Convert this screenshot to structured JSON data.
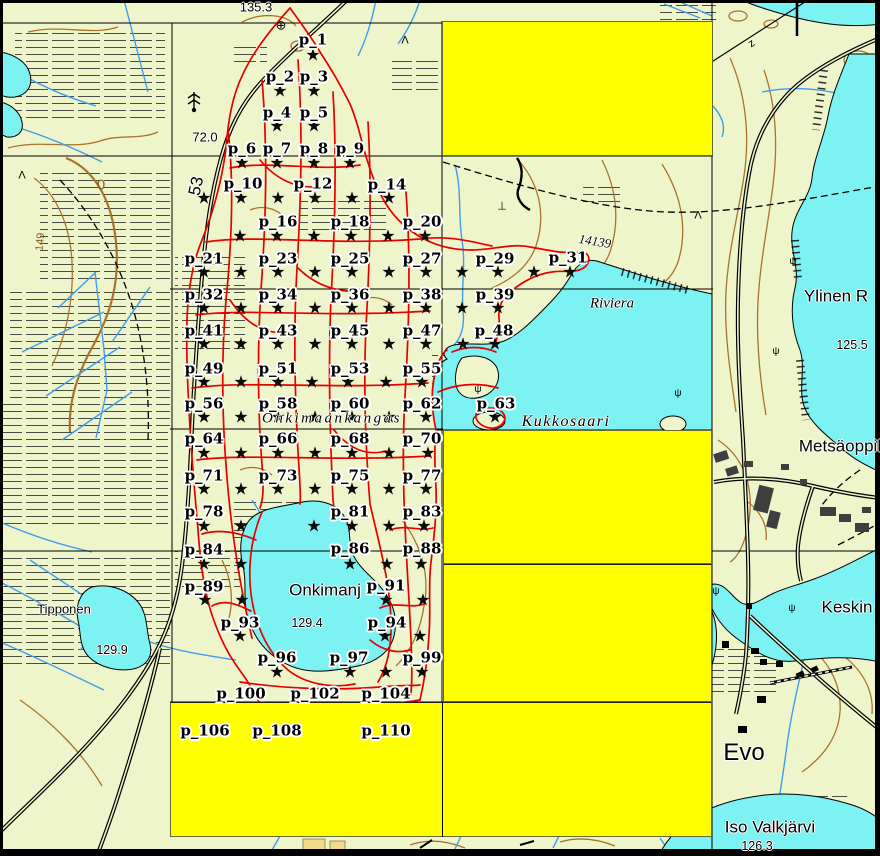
{
  "map_view": {
    "colors": {
      "terrain": "#EFF5CB",
      "water": "#7DF2F2",
      "highlight": "#FFFF00",
      "trail": "#E60000",
      "contour": "#A9732C",
      "stream": "#3E9CEE",
      "road": "#000000",
      "grid": "#000000",
      "building": "#3F3F3F",
      "sand": "#F2D98B",
      "label_halo": "#FFFFFF",
      "label_text": "#000000"
    },
    "sample_points": {
      "marker_glyph": "★",
      "labels": [
        {
          "label": "p_1",
          "x": 313,
          "y": 40
        },
        {
          "label": "p_2",
          "x": 280,
          "y": 77
        },
        {
          "label": "p_3",
          "x": 314,
          "y": 77
        },
        {
          "label": "p_4",
          "x": 277,
          "y": 113
        },
        {
          "label": "p_5",
          "x": 314,
          "y": 113
        },
        {
          "label": "p_6",
          "x": 242,
          "y": 149
        },
        {
          "label": "p_7",
          "x": 277,
          "y": 149
        },
        {
          "label": "p_8",
          "x": 314,
          "y": 149
        },
        {
          "label": "p_9",
          "x": 350,
          "y": 149
        },
        {
          "label": "p_10",
          "x": 243,
          "y": 184
        },
        {
          "label": "p_12",
          "x": 313,
          "y": 184
        },
        {
          "label": "p_14",
          "x": 387,
          "y": 185
        },
        {
          "label": "p_16",
          "x": 278,
          "y": 222
        },
        {
          "label": "p_18",
          "x": 350,
          "y": 222
        },
        {
          "label": "p_20",
          "x": 422,
          "y": 222
        },
        {
          "label": "p_21",
          "x": 204,
          "y": 259
        },
        {
          "label": "p_23",
          "x": 278,
          "y": 259
        },
        {
          "label": "p_25",
          "x": 350,
          "y": 259
        },
        {
          "label": "p_27",
          "x": 422,
          "y": 259
        },
        {
          "label": "p_29",
          "x": 495,
          "y": 259
        },
        {
          "label": "p_31",
          "x": 568,
          "y": 258
        },
        {
          "label": "p_32",
          "x": 204,
          "y": 295
        },
        {
          "label": "p_34",
          "x": 278,
          "y": 295
        },
        {
          "label": "p_36",
          "x": 350,
          "y": 295
        },
        {
          "label": "p_38",
          "x": 422,
          "y": 295
        },
        {
          "label": "p_39",
          "x": 495,
          "y": 295
        },
        {
          "label": "p_41",
          "x": 204,
          "y": 331
        },
        {
          "label": "p_43",
          "x": 278,
          "y": 331
        },
        {
          "label": "p_45",
          "x": 350,
          "y": 331
        },
        {
          "label": "p_47",
          "x": 422,
          "y": 331
        },
        {
          "label": "p_48",
          "x": 494,
          "y": 331
        },
        {
          "label": "p_49",
          "x": 204,
          "y": 369
        },
        {
          "label": "p_51",
          "x": 278,
          "y": 369
        },
        {
          "label": "p_53",
          "x": 350,
          "y": 369
        },
        {
          "label": "p_55",
          "x": 422,
          "y": 369
        },
        {
          "label": "p_56",
          "x": 204,
          "y": 404
        },
        {
          "label": "p_58",
          "x": 278,
          "y": 404
        },
        {
          "label": "p_60",
          "x": 350,
          "y": 404
        },
        {
          "label": "p_62",
          "x": 422,
          "y": 404
        },
        {
          "label": "p_63",
          "x": 496,
          "y": 404
        },
        {
          "label": "p_64",
          "x": 204,
          "y": 439
        },
        {
          "label": "p_66",
          "x": 278,
          "y": 439
        },
        {
          "label": "p_68",
          "x": 350,
          "y": 439
        },
        {
          "label": "p_70",
          "x": 422,
          "y": 439
        },
        {
          "label": "p_71",
          "x": 204,
          "y": 476
        },
        {
          "label": "p_73",
          "x": 278,
          "y": 476
        },
        {
          "label": "p_75",
          "x": 350,
          "y": 476
        },
        {
          "label": "p_77",
          "x": 422,
          "y": 476
        },
        {
          "label": "p_78",
          "x": 204,
          "y": 512
        },
        {
          "label": "p_81",
          "x": 350,
          "y": 512
        },
        {
          "label": "p_83",
          "x": 422,
          "y": 512
        },
        {
          "label": "p_84",
          "x": 204,
          "y": 550
        },
        {
          "label": "p_86",
          "x": 350,
          "y": 549
        },
        {
          "label": "p_88",
          "x": 422,
          "y": 549
        },
        {
          "label": "p_89",
          "x": 204,
          "y": 587
        },
        {
          "label": "p_91",
          "x": 386,
          "y": 586
        },
        {
          "label": "p_93",
          "x": 240,
          "y": 623
        },
        {
          "label": "p_94",
          "x": 387,
          "y": 623
        },
        {
          "label": "p_96",
          "x": 277,
          "y": 658
        },
        {
          "label": "p_97",
          "x": 349,
          "y": 658
        },
        {
          "label": "p_99",
          "x": 422,
          "y": 658
        },
        {
          "label": "p_100",
          "x": 241,
          "y": 694
        },
        {
          "label": "p_102",
          "x": 315,
          "y": 694
        },
        {
          "label": "p_104",
          "x": 386,
          "y": 694
        },
        {
          "label": "p_106",
          "x": 205,
          "y": 731
        },
        {
          "label": "p_108",
          "x": 277,
          "y": 731
        },
        {
          "label": "p_110",
          "x": 386,
          "y": 731
        }
      ]
    },
    "star_rows": [
      {
        "y": 57,
        "xs": [
          313
        ]
      },
      {
        "y": 93,
        "xs": [
          280,
          314
        ]
      },
      {
        "y": 128,
        "xs": [
          277,
          314
        ]
      },
      {
        "y": 165,
        "xs": [
          242,
          277,
          314,
          350
        ]
      },
      {
        "y": 200,
        "xs": [
          204,
          241,
          278,
          315,
          352,
          389
        ]
      },
      {
        "y": 238,
        "xs": [
          240,
          277,
          314,
          351,
          388,
          425
        ]
      },
      {
        "y": 274,
        "xs": [
          204,
          241,
          278,
          315,
          352,
          389,
          426,
          462,
          498,
          534,
          570
        ]
      },
      {
        "y": 310,
        "xs": [
          204,
          241,
          278,
          315,
          352,
          389,
          426,
          462,
          498
        ]
      },
      {
        "y": 346,
        "xs": [
          204,
          241,
          278,
          315,
          352,
          389,
          426,
          463,
          495
        ]
      },
      {
        "y": 384,
        "xs": [
          204,
          241,
          278,
          312,
          348,
          386,
          422
        ]
      },
      {
        "y": 419,
        "xs": [
          204,
          241,
          278,
          315,
          352,
          389,
          426,
          495
        ]
      },
      {
        "y": 455,
        "xs": [
          204,
          241,
          278,
          315,
          352,
          389,
          428
        ]
      },
      {
        "y": 491,
        "xs": [
          204,
          241,
          278,
          315,
          352,
          389,
          426
        ]
      },
      {
        "y": 528,
        "xs": [
          204,
          241,
          314,
          352,
          389,
          424
        ]
      },
      {
        "y": 566,
        "xs": [
          204,
          241,
          350,
          387,
          421
        ]
      },
      {
        "y": 602,
        "xs": [
          205,
          242,
          386,
          423
        ]
      },
      {
        "y": 638,
        "xs": [
          240,
          385,
          420
        ]
      },
      {
        "y": 674,
        "xs": [
          277,
          350,
          386,
          422
        ]
      }
    ],
    "place_labels": [
      {
        "text": "135.3",
        "x": 256,
        "y": 7,
        "cls": "num-lg"
      },
      {
        "text": "⊕",
        "x": 281,
        "y": 25,
        "cls": "sym"
      },
      {
        "text": "72.0",
        "x": 205,
        "y": 137,
        "cls": "num-lg"
      },
      {
        "text": "53",
        "x": 196,
        "y": 186,
        "cls": "road-num",
        "rot": -78
      },
      {
        "text": "149",
        "x": 41,
        "y": 242,
        "cls": "contour-num",
        "rot": -84
      },
      {
        "text": "0",
        "x": 101,
        "y": 185,
        "cls": "contour-num-lg"
      },
      {
        "text": "14139",
        "x": 595,
        "y": 241,
        "cls": "italic-num",
        "rot": 9
      },
      {
        "text": "z",
        "x": 752,
        "y": 44,
        "cls": "sym-sm",
        "rot": -35
      },
      {
        "text": "Riviera",
        "x": 612,
        "y": 304,
        "cls": "water-name"
      },
      {
        "text": "Ylinen R",
        "x": 836,
        "y": 296,
        "cls": "place"
      },
      {
        "text": "125.5",
        "x": 852,
        "y": 345,
        "cls": "num"
      },
      {
        "text": "Kukkosaari",
        "x": 566,
        "y": 422,
        "cls": "water-name-lg"
      },
      {
        "text": "Onkimaankangas",
        "x": 332,
        "y": 419,
        "cls": "area-name"
      },
      {
        "text": "Metsäoppil",
        "x": 840,
        "y": 446,
        "cls": "place"
      },
      {
        "text": "Onkimanj",
        "x": 325,
        "y": 590,
        "cls": "place"
      },
      {
        "text": "129.4",
        "x": 307,
        "y": 623,
        "cls": "num"
      },
      {
        "text": "Keskin",
        "x": 847,
        "y": 607,
        "cls": "place-lg"
      },
      {
        "text": "Tipponen",
        "x": 64,
        "y": 609,
        "cls": "place-sm"
      },
      {
        "text": "129.9",
        "x": 112,
        "y": 650,
        "cls": "num"
      },
      {
        "text": "Evo",
        "x": 744,
        "y": 753,
        "cls": "place-xl"
      },
      {
        "text": "Iso Valkjärvi",
        "x": 770,
        "y": 827,
        "cls": "place"
      },
      {
        "text": "126.3",
        "x": 757,
        "y": 846,
        "cls": "num"
      },
      {
        "text": "Λ",
        "x": 405,
        "y": 41,
        "cls": "sym-sm"
      },
      {
        "text": "Λ",
        "x": 22,
        "y": 176,
        "cls": "sym-sm"
      },
      {
        "text": "Λ",
        "x": 698,
        "y": 216,
        "cls": "sym-sm"
      },
      {
        "text": "⊥",
        "x": 502,
        "y": 207,
        "cls": "sym-sm"
      },
      {
        "text": "ψ",
        "x": 793,
        "y": 262,
        "cls": "tuft"
      },
      {
        "text": "ψ",
        "x": 776,
        "y": 352,
        "cls": "tuft"
      },
      {
        "text": "ψ",
        "x": 478,
        "y": 390,
        "cls": "tuft"
      },
      {
        "text": "ψ",
        "x": 678,
        "y": 394,
        "cls": "tuft"
      },
      {
        "text": "ψ",
        "x": 716,
        "y": 592,
        "cls": "tuft"
      },
      {
        "text": "ψ",
        "x": 792,
        "y": 609,
        "cls": "tuft"
      }
    ],
    "highlight_rects": [
      {
        "x": 442,
        "y": 21,
        "w": 271,
        "h": 135
      },
      {
        "x": 443,
        "y": 430,
        "w": 269,
        "h": 134
      },
      {
        "x": 443,
        "y": 564,
        "w": 269,
        "h": 138
      },
      {
        "x": 170,
        "y": 702,
        "w": 542,
        "h": 135
      }
    ]
  }
}
